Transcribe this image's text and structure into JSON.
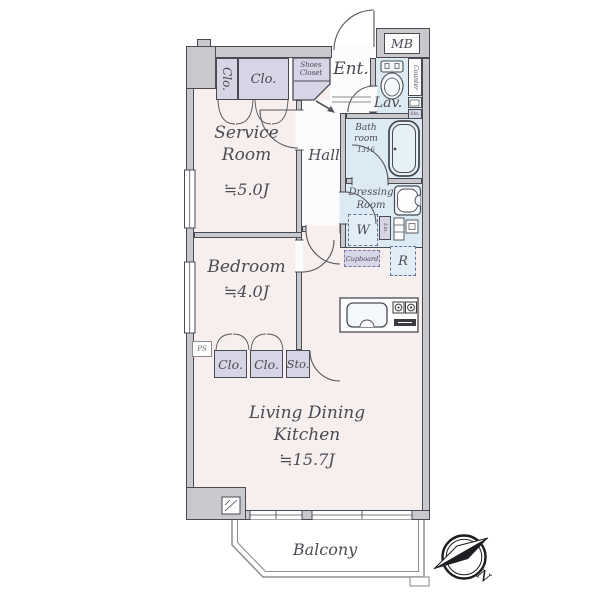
{
  "rooms": {
    "service_room": {
      "name": "Service Room",
      "size": "≒5.0J"
    },
    "hall": {
      "name": "Hall"
    },
    "entrance": {
      "name": "Ent."
    },
    "lavatory": {
      "name": "Lav."
    },
    "bathroom": {
      "name": "Bath room",
      "size": "1316"
    },
    "dressing_room": {
      "name": "Dressing Room"
    },
    "bedroom": {
      "name": "Bedroom",
      "size": "≒4.0J"
    },
    "ldk": {
      "name": "Living Dining Kitchen",
      "size": "≒15.7J"
    },
    "balcony": {
      "name": "Balcony"
    }
  },
  "storage": {
    "closet_entry_side": "Clo.",
    "closet_entry_top": "Clo.",
    "shoes_closet": "Shoes Closet",
    "bedroom_closet_1": "Clo.",
    "bedroom_closet_2": "Clo.",
    "bedroom_storage": "Sto.",
    "cupboard": "Cupboard",
    "linen": "Lin.",
    "lavatory_storage": "Sto."
  },
  "equipment": {
    "meter_box": "MB",
    "counter": "Counter",
    "washing_machine": "W",
    "refrigerator": "R",
    "pipe_space": "PS"
  },
  "compass": {
    "north": "N"
  },
  "colors": {
    "wall_fill": "#c8c8cd",
    "room_floor": "#f6efee",
    "wet_area": "#dcebf3",
    "closet_fill": "#d7d4e6",
    "outline": "#4a4a52"
  }
}
